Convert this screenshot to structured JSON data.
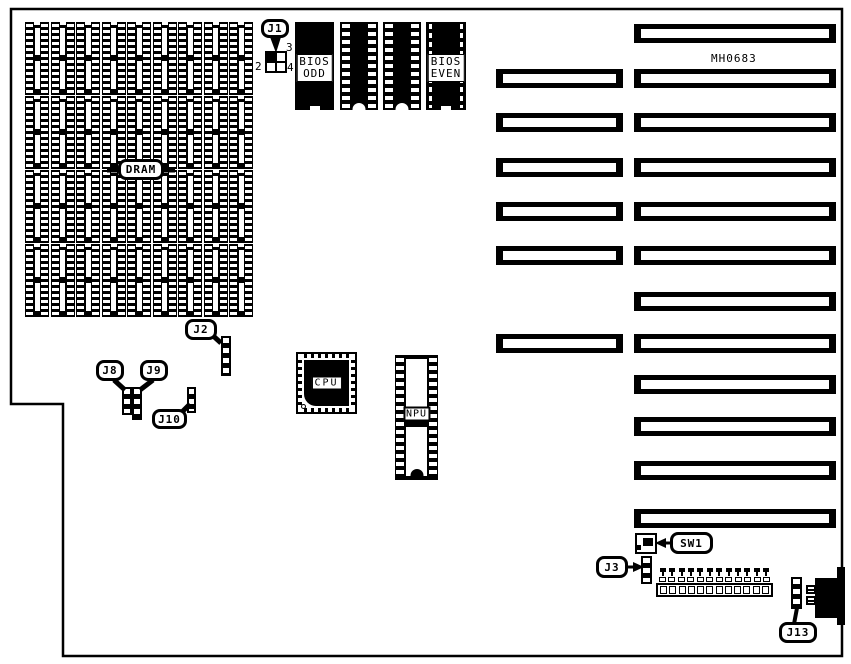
{
  "diagram_title": "MH0683 motherboard component layout",
  "labels": {
    "model": "MH0683",
    "dram": "DRAM",
    "cpu": "CPU",
    "npu": "NPU",
    "j1": "J1",
    "j2": "J2",
    "j3": "J3",
    "j8": "J8",
    "j9": "J9",
    "j10": "J10",
    "j13": "J13",
    "sw1": "SW1"
  },
  "bios": {
    "line1": "BIOS",
    "odd": "ODD",
    "even": "EVEN"
  },
  "j1_pins": {
    "top_right": "3",
    "bottom_left": "2",
    "bottom_right": "4"
  },
  "counts": {
    "dram_rows": 4,
    "dram_chips_per_row": 9,
    "long_slots": 12,
    "short_slots": 6,
    "connector_positions": 12
  },
  "colors": {
    "ink": "#000000",
    "background": "#ffffff"
  }
}
